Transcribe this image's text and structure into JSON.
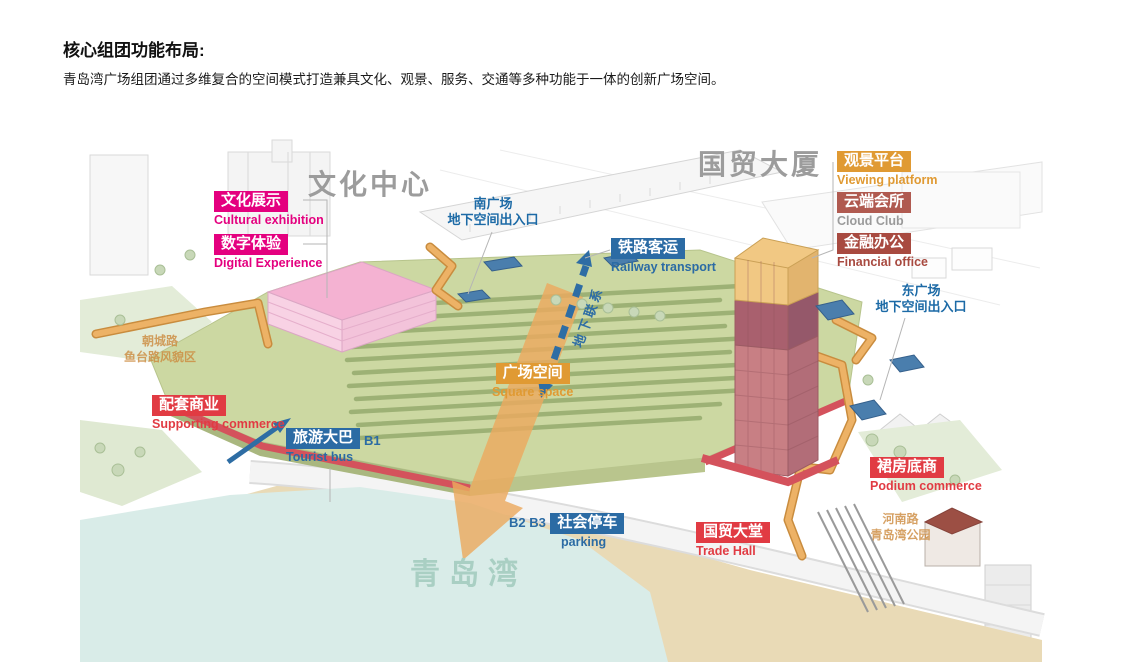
{
  "header": {
    "title": "核心组团功能布局:",
    "subtitle": "青岛湾广场组团通过多维复合的空间模式打造兼具文化、观景、服务、交通等多种功能于一体的创新广场空间。"
  },
  "diagram": {
    "area_titles": {
      "culture_center": "文化中心",
      "trade_tower": "国贸大厦",
      "qingdao_bay": "青岛湾"
    },
    "labels": {
      "cultural_exhibition": {
        "zh": "文化展示",
        "en": "Cultural exhibition"
      },
      "digital_experience": {
        "zh": "数字体验",
        "en": "Digital Experience"
      },
      "railway_transport": {
        "zh": "铁路客运",
        "en": "Railway transport"
      },
      "viewing_platform": {
        "zh": "观景平台",
        "en": "Viewing platform"
      },
      "cloud_club": {
        "zh": "云端会所",
        "en": "Cloud Club"
      },
      "financial_office": {
        "zh": "金融办公",
        "en": "Financial office"
      },
      "supporting_commerce": {
        "zh": "配套商业",
        "en": "Supporting commerce"
      },
      "tourist_bus": {
        "zh": "旅游大巴",
        "en": "Tourist bus",
        "level": "B1"
      },
      "square_space": {
        "zh": "广场空间",
        "en": "Square space"
      },
      "parking": {
        "zh": "社会停车",
        "en": "parking",
        "levels": "B2 B3"
      },
      "trade_hall": {
        "zh": "国贸大堂",
        "en": "Trade Hall"
      },
      "podium_commerce": {
        "zh": "裙房底商",
        "en": "Podium commerce"
      }
    },
    "annotations": {
      "south_square": {
        "line1": "南广场",
        "line2": "地下空间出入口"
      },
      "east_square": {
        "line1": "东广场",
        "line2": "地下空间出入口"
      },
      "underground_link": "地下联系",
      "chaocheng_road": {
        "line1": "朝城路",
        "line2": "鱼台路风貌区"
      },
      "henan_road": {
        "line1": "河南路",
        "line2": "青岛湾公园"
      }
    },
    "colors": {
      "magenta_tag": "#e4007f",
      "blue_tag": "#2b6ba4",
      "orange_tag": "#e09a33",
      "brick_tag": "#b05a50",
      "dark_brick_tag": "#a84a40",
      "red_tag": "#e13b43",
      "big_title_gray": "#9c9c9c",
      "bay_text": "#a9cfc3",
      "road_note_orange": "#cc8a3e",
      "deck_green": "#ccd8a2",
      "stripe_green": "#9db175",
      "building_pink": "#f4b2d2",
      "tower_red": "#c87f84",
      "tower_top_yellow": "#f1c883",
      "water_blue": "#d9ece8",
      "beach_tan": "#e9dab6",
      "path_orange": "#edb266",
      "arrow_blue": "#2e6da4",
      "flow_arrow_orange": "#eca95f"
    }
  }
}
